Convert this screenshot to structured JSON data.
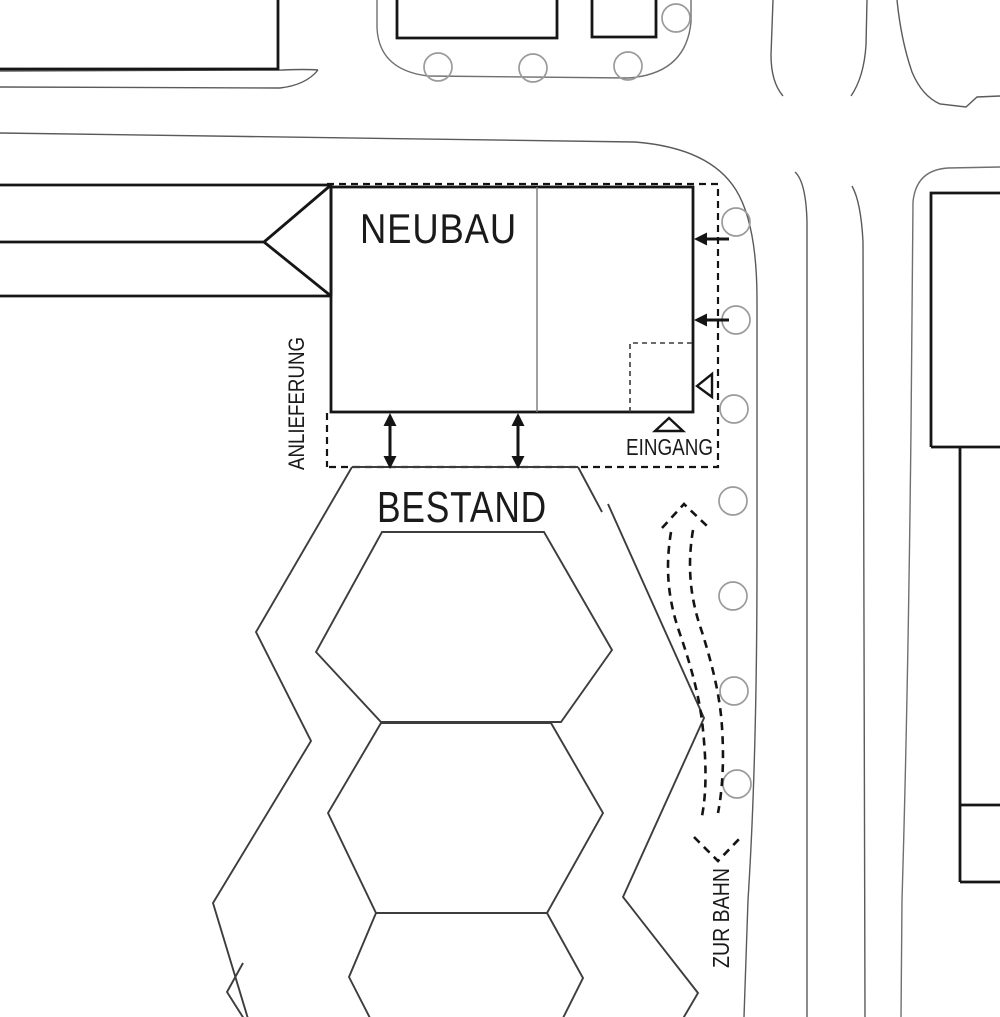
{
  "labels": {
    "neubau": "NEUBAU",
    "bestand": "BESTAND",
    "anlieferung": "ANLIEFERUNG",
    "eingang": "EINGANG",
    "zur_bahn": "ZUR BAHN"
  },
  "colors": {
    "background": "#ffffff",
    "building_line": "#161616",
    "existing_building_line": "#3d3d3d",
    "road_line": "#5a5a5a",
    "plot_boundary_line": "#6f6f6f",
    "tree_line": "#9b9b9b",
    "dashed_marking": "#141414",
    "text": "#1a1a1a"
  }
}
